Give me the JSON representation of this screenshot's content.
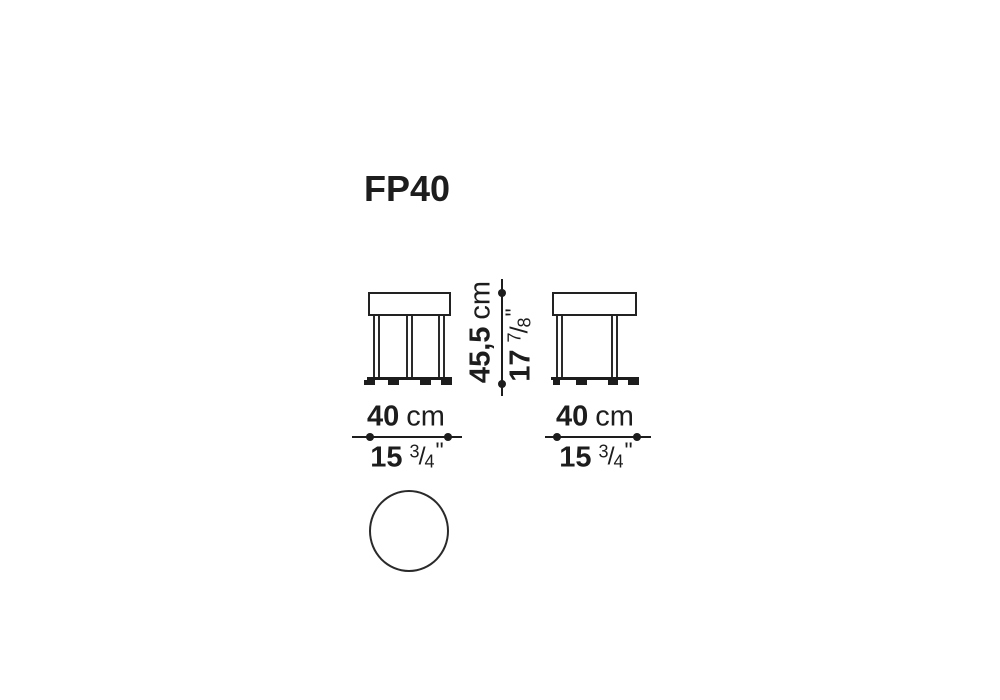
{
  "title": "FP40",
  "symbols": {
    "fraction_slash": "/",
    "inch_mark": "\""
  },
  "dimensions": {
    "height": {
      "cm_value": "45,5",
      "cm_unit": "cm",
      "inch_whole": "17",
      "inch_frac_numerator": "7",
      "inch_frac_denominator": "8"
    },
    "width_front": {
      "cm_value": "40",
      "cm_unit": "cm",
      "inch_whole": "15",
      "inch_frac_numerator": "3",
      "inch_frac_denominator": "4"
    },
    "width_side": {
      "cm_value": "40",
      "cm_unit": "cm",
      "inch_whole": "15",
      "inch_frac_numerator": "3",
      "inch_frac_denominator": "4"
    }
  },
  "colors": {
    "ink": "#1d1d1d",
    "background": "#ffffff"
  }
}
